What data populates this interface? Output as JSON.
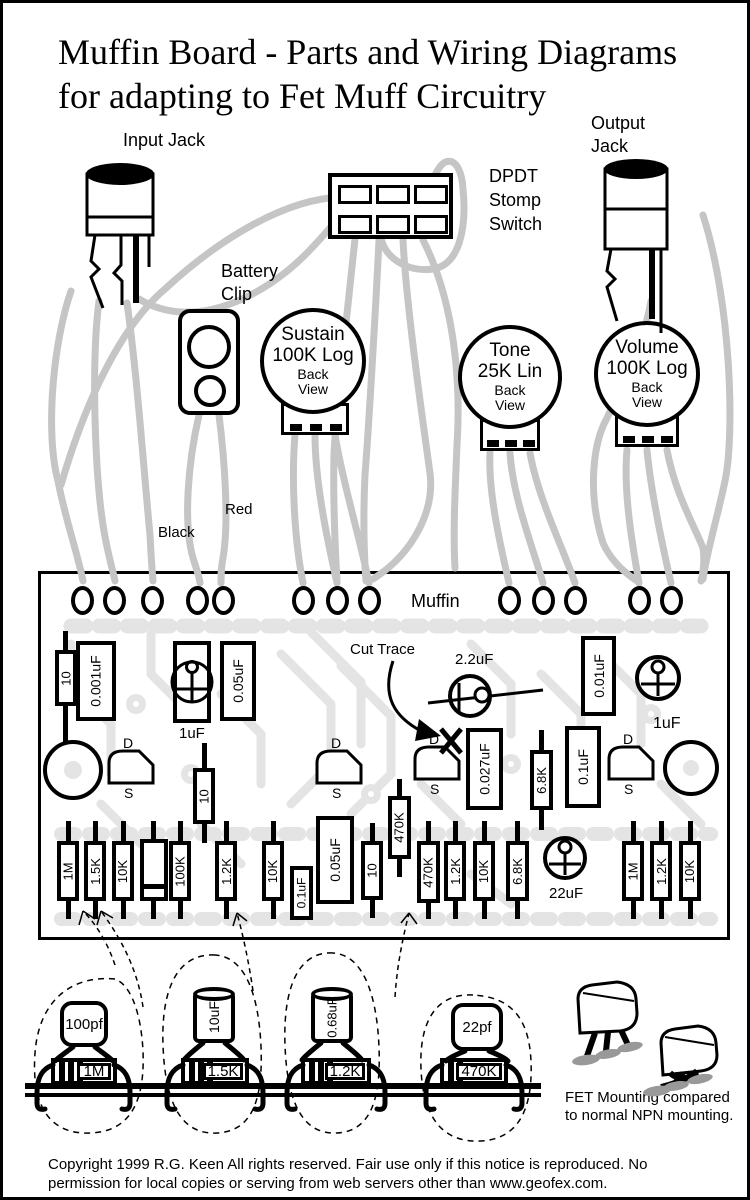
{
  "title": {
    "line1": "Muffin Board -  Parts and Wiring Diagrams",
    "line2": "for adapting to Fet Muff Circuitry"
  },
  "labels": {
    "input_jack": "Input Jack",
    "output_jack_1": "Output",
    "output_jack_2": "Jack",
    "dpdt_1": "DPDT",
    "dpdt_2": "Stomp",
    "dpdt_3": "Switch",
    "battery_1": "Battery",
    "battery_2": "Clip",
    "red": "Red",
    "black": "Black"
  },
  "pots": [
    {
      "name": "Sustain",
      "value": "100K Log",
      "view1": "Back",
      "view2": "View"
    },
    {
      "name": "Tone",
      "value": "25K Lin",
      "view1": "Back",
      "view2": "View"
    },
    {
      "name": "Volume",
      "value": "100K Log",
      "view1": "Back",
      "view2": "View"
    }
  ],
  "board": {
    "name": "Muffin",
    "cut_trace": "Cut Trace",
    "pins": {
      "d": "D",
      "g": "G",
      "s": "S"
    },
    "row2": [
      "10",
      "0.001uF",
      "1uF",
      "0.05uF",
      "2.2uF",
      "0.01uF",
      "1uF"
    ],
    "row3": [
      "10",
      "0.027uF",
      "6.8K",
      "0.1uF"
    ],
    "bottom_row": [
      "1M",
      "1.5K",
      "10K",
      "100K",
      "1.2K",
      "10K",
      "0.1uF",
      "0.05uF",
      "10",
      "470K",
      "470K",
      "1.2K",
      "10K",
      "6.8K",
      "22uF",
      "1M",
      "1.2K",
      "10K"
    ]
  },
  "substitutions": [
    {
      "cap": "100pf",
      "resistor": "1M"
    },
    {
      "cap": "10uF",
      "resistor": "1.5K"
    },
    {
      "cap": "0.68uF",
      "resistor": "1.2K"
    },
    {
      "cap": "22pf",
      "resistor": "470K"
    }
  ],
  "fet_mounting": {
    "npn_pins": [
      "E",
      "B",
      "C"
    ],
    "fet_pins": [
      "D",
      "S",
      "G"
    ],
    "caption_1": "FET Mounting compared",
    "caption_2": "to normal NPN mounting."
  },
  "copyright": {
    "line1": "Copyright 1999 R.G. Keen  All rights reserved. Fair use only if this notice is reproduced. No",
    "line2": "permission for local copies or serving from web servers other than www.geofex.com."
  },
  "colors": {
    "wire": "#c5c5c5",
    "trace": "#e4e4e4"
  }
}
